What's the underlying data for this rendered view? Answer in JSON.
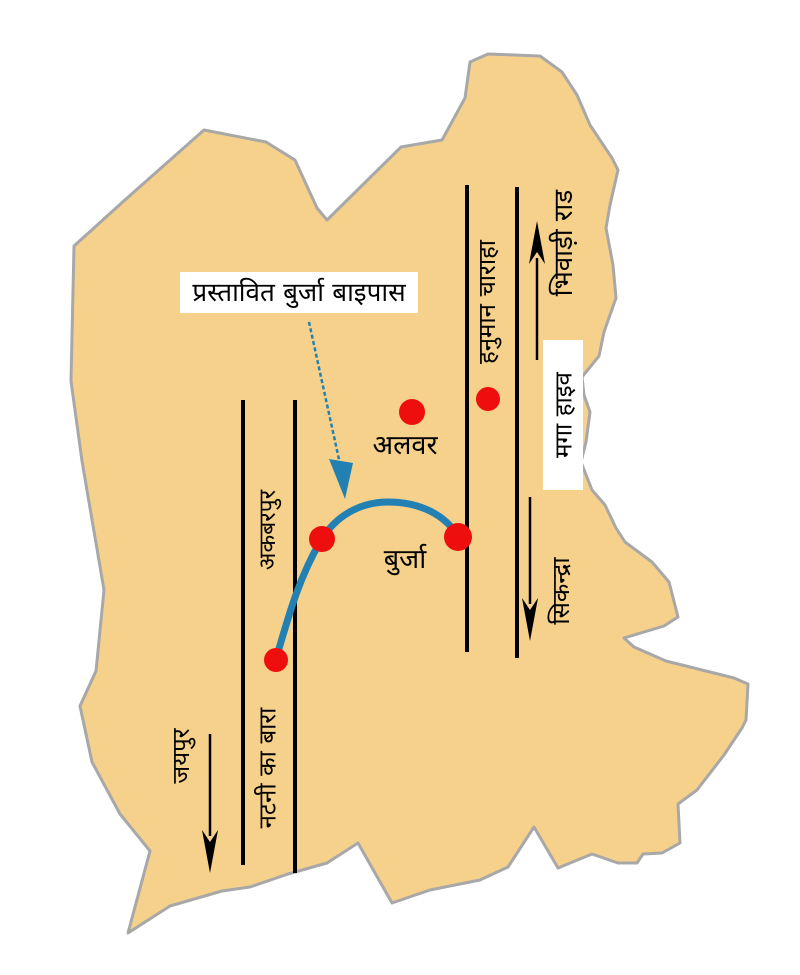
{
  "labels": {
    "proposed_bypass": "प्रस्तावित बुर्जा बाइपास",
    "bhiwadi_road": "भिवाड़ी राड",
    "hanuman_chauraha": "हनुमान चाराहा",
    "mega_highway": "मगा हाइव",
    "sikandra": "सिकन्द्रा",
    "akbarpur": "अकबरपुर",
    "natni_ka_bara": "नटनी का बारा",
    "jaipur": "जयपुर",
    "alwar": "अलवर",
    "burja": "बुर्जा"
  },
  "markers": {
    "count": 5,
    "locations": [
      "alwar",
      "hanuman-chauraha-road",
      "bypass-west-junction",
      "burja",
      "natni-ka-bara-road"
    ]
  },
  "colors": {
    "region_fill": "#F6D18C",
    "region_stroke": "#A8A8A8",
    "road_line": "#000000",
    "bypass_line": "#2281B2",
    "marker": "#EF0E0E",
    "label_bg": "#FFFFFF"
  }
}
